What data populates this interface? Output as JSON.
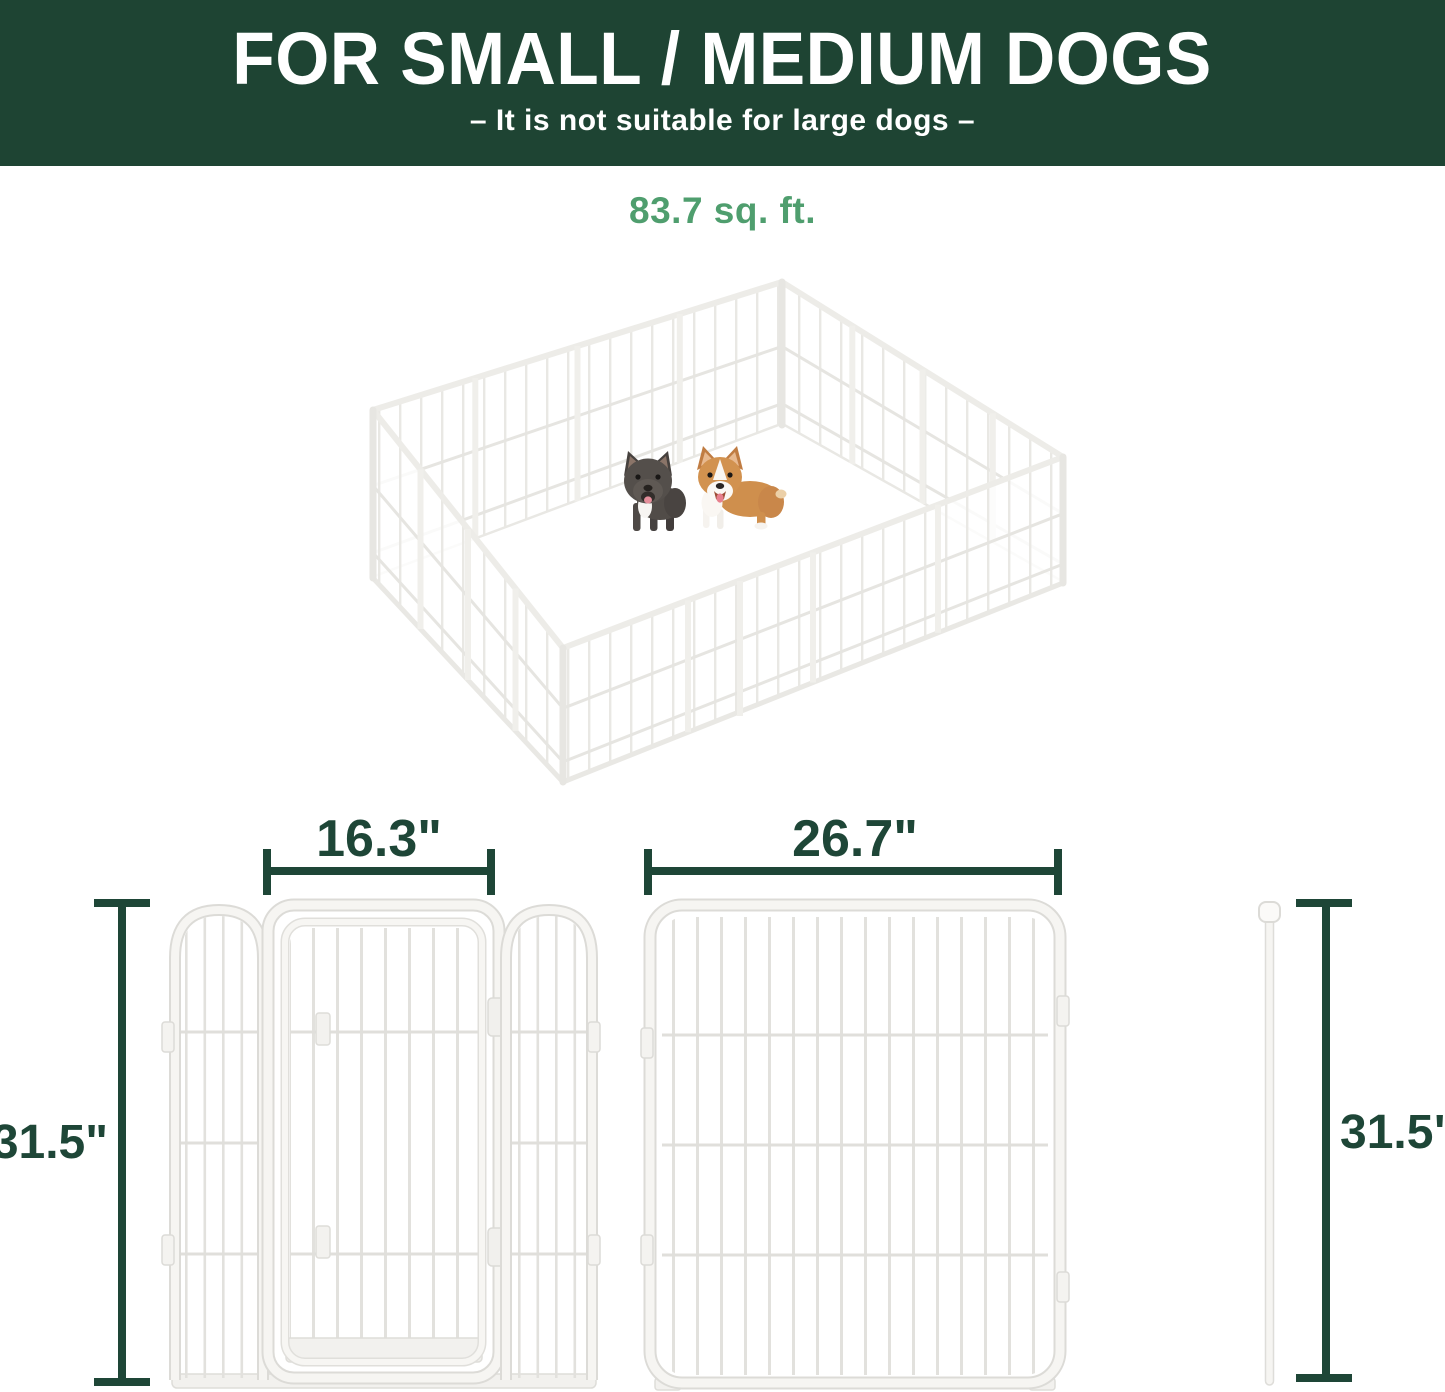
{
  "banner": {
    "title": "FOR SMALL / MEDIUM DOGS",
    "subtitle": "–  It is not suitable for large dogs  –"
  },
  "area_label": "83.7 sq. ft.",
  "illustration": {
    "name": "isometric 16-panel white metal dog playpen",
    "dogs": [
      "french-bulldog",
      "corgi"
    ]
  },
  "dimensions": {
    "door_width": "16.3\"",
    "large_panel_width": "26.7\"",
    "panel_height": "31.5\"",
    "rod_height": "31.5\""
  },
  "colors": {
    "banner_bg": "#1e4433",
    "banner_text": "#ffffff",
    "area_green": "#4f9e6e",
    "dimension_green": "#1e4637",
    "panel_white": "#f5f4f1",
    "panel_outline": "#dcdbd7"
  }
}
